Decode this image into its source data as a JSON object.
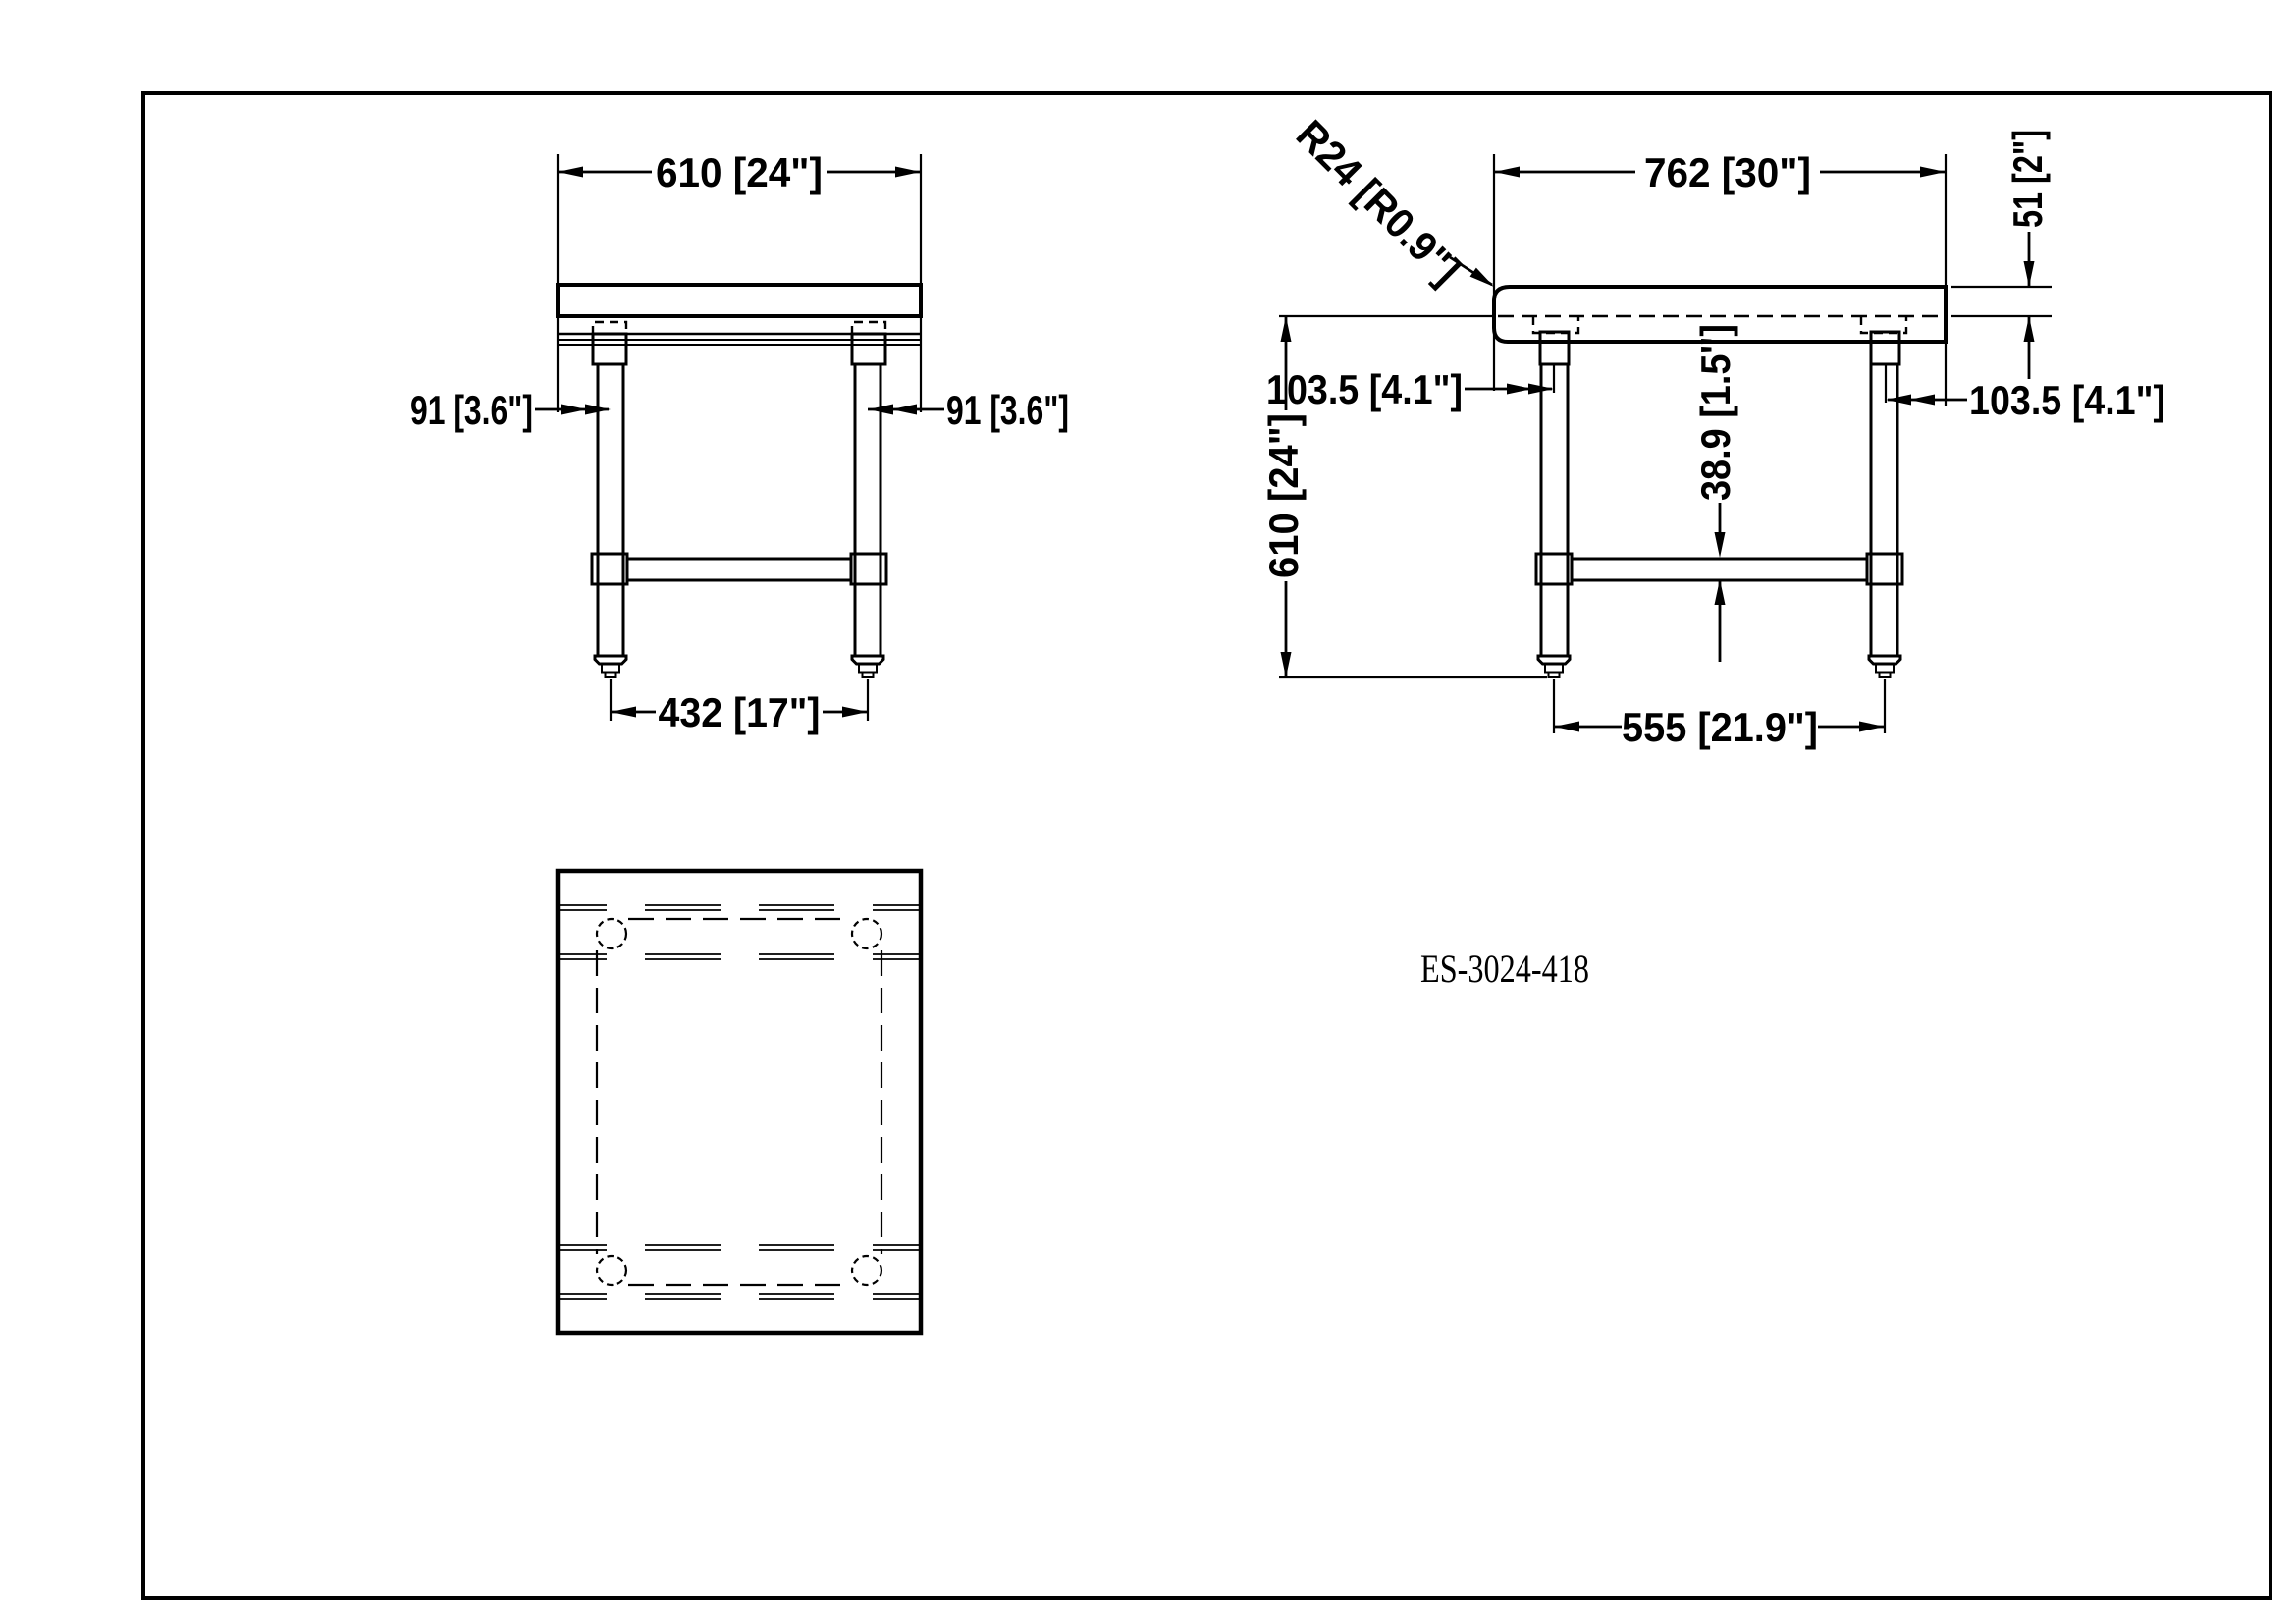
{
  "drawing": {
    "model_number": "ES-3024-418",
    "front_view": {
      "dim_top_width": "610 [24\"]",
      "dim_leg_offset_left": "91 [3.6\"]",
      "dim_leg_offset_right": "91 [3.6\"]",
      "dim_feet_span": "432 [17\"]"
    },
    "side_view": {
      "dim_top_depth": "762 [30\"]",
      "dim_corner_radius": "R24 [R0.9\"]",
      "dim_top_thickness": "51 [2\"]",
      "dim_leg_inset_left": "103.5 [4.1\"]",
      "dim_leg_inset_right": "103.5 [4.1\"]",
      "dim_height": "610 [24\"]",
      "dim_brace_height": "38.9 [1.5\"]",
      "dim_feet_span": "555 [21.9\"]"
    }
  }
}
